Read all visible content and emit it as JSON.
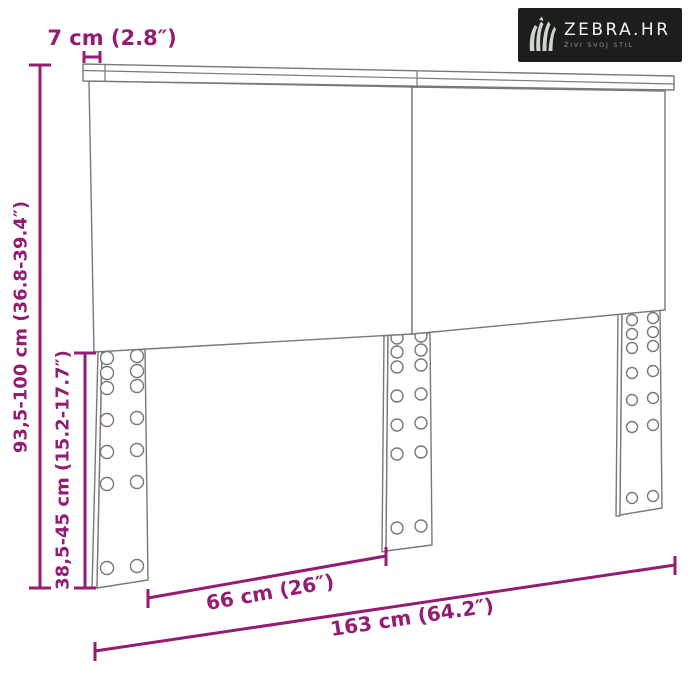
{
  "brand": {
    "name": "ZEBRA.HR",
    "tagline": "ŽIVI SVOJ STIL",
    "bg_color": "#1d1d1b",
    "text_color": "#f5f5f5"
  },
  "diagram": {
    "accent_color": "#941c72",
    "line_color": "#787878",
    "labels": {
      "board_depth": "7 cm (2.8″)",
      "total_height": "93,5-100 cm (36.8-39.4″)",
      "leg_height": "38,5-45 cm (15.2-17.7″)",
      "inner_width": "66 cm (26″)",
      "total_width": "163 cm (64.2″)"
    },
    "measurements": [
      {
        "dimension": "top-board-depth",
        "metric": "7 cm",
        "imperial": "2.8″"
      },
      {
        "dimension": "total-height",
        "metric": "93,5-100 cm",
        "imperial": "36.8-39.4″"
      },
      {
        "dimension": "leg-height-below-panel",
        "metric": "38,5-45 cm",
        "imperial": "15.2-17.7″"
      },
      {
        "dimension": "spacing-between-legs",
        "metric": "66 cm",
        "imperial": "26″"
      },
      {
        "dimension": "total-width",
        "metric": "163 cm",
        "imperial": "64.2″"
      }
    ]
  }
}
